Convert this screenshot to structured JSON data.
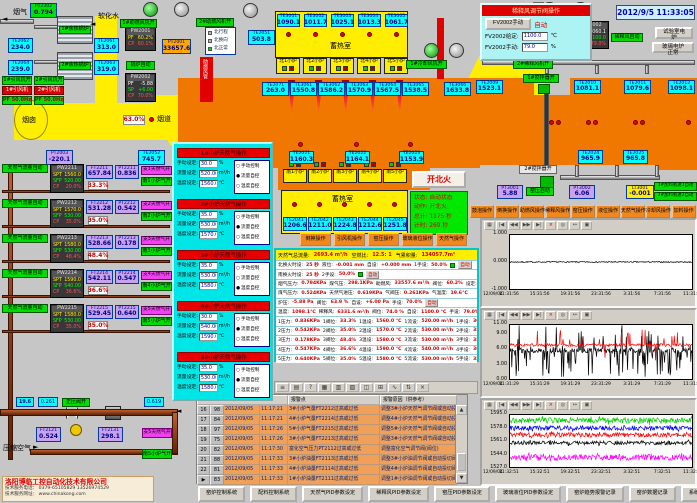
{
  "clock": "2012/9/5 11:33:05",
  "labels": {
    "flue_gas": "烟气",
    "soft_water": "软化水",
    "chimney": "烟囱",
    "flue": "烟道",
    "regen_north": "蓄热室",
    "regen_south": "蓄热室",
    "duct_red": "助燃风管",
    "compressed_air": "压缩空气",
    "fan_open": "开"
  },
  "top_left": {
    "pt2302": {
      "id": "PT2302",
      "value": "0.794"
    },
    "boilers": [
      "1#余热锅炉",
      "2#余热锅炉"
    ],
    "te": [
      {
        "id": "TE2062",
        "value": "234.0"
      },
      {
        "id": "TE2061",
        "value": "313.0"
      },
      {
        "id": "TE2064",
        "value": "239.0"
      },
      {
        "id": "TE2063",
        "value": "319.0"
      }
    ],
    "fan_status": [
      "1#引风机开",
      "2#引风机开"
    ],
    "fan_names": [
      "1#引风机",
      "2#引风机"
    ],
    "fan_freq": [
      "PF 50.0Hz",
      "PF 50.0Hz"
    ],
    "flue_valve_pct": "63.0%",
    "pt2003": {
      "id": "PT2003",
      "value": "-220.1"
    },
    "te2052": {
      "id": "TE2052",
      "value": "745.7"
    }
  },
  "top_center": {
    "te2051": {
      "id": "TE2051",
      "value": "503.8"
    },
    "regen_te": [
      {
        "id": "TE3001",
        "value": "1090.1"
      },
      {
        "id": "TE3002",
        "value": "1011.7"
      },
      {
        "id": "TE3003",
        "value": "1025.1"
      },
      {
        "id": "TE3004",
        "value": "1013.3"
      },
      {
        "id": "TE3005",
        "value": "1061.7"
      }
    ],
    "north_furnaces": [
      "北1小炉",
      "北2小炉",
      "北3小炉",
      "北4小炉",
      "北5小炉"
    ],
    "pw2001": {
      "id": "PW2001",
      "rows": [
        {
          "k": "PF",
          "v": "60.2%",
          "c": "cy"
        },
        {
          "k": "CP",
          "v": "60.1%",
          "c": "cr"
        }
      ]
    },
    "pt2001": {
      "id": "PT2001",
      "value": "33657.6"
    },
    "boiler_auto": "锅炉自动",
    "pw2002": {
      "id": "PW2002",
      "rows": [
        {
          "k": "PF",
          "v": "-5.88",
          "c": "cw"
        },
        {
          "k": "SP",
          "v": "+6.00",
          "c": "cg"
        },
        {
          "k": "CP",
          "v": "70.0%",
          "c": "cr"
        }
      ]
    },
    "fan1_status": "1#助燃风机开",
    "fan2_status": "2#助燃风机开",
    "mode_list": [
      {
        "t": "北行程",
        "on": false
      },
      {
        "t": "北换向",
        "on": false
      },
      {
        "t": "北正常",
        "on": true
      }
    ],
    "cooling_fan": "1#冷却风机开"
  },
  "furnace": {
    "top_te": [
      {
        "id": "TE2071",
        "value": "263.0"
      },
      {
        "id": "TE3061",
        "value": "1550.8"
      },
      {
        "id": "TE3062",
        "value": "1586.2"
      },
      {
        "id": "TE3063",
        "value": "1570.9"
      },
      {
        "id": "TE3064",
        "value": "1567.5"
      },
      {
        "id": "TE3065",
        "value": "1538.5"
      },
      {
        "id": "TE3066",
        "value": "1633.8"
      }
    ],
    "right_te": [
      {
        "id": "TE2009",
        "value": "1523.1"
      },
      {
        "id": "TE2010",
        "value": "1081.1"
      },
      {
        "id": "TE2011",
        "value": "1079.6"
      },
      {
        "id": "TE2012",
        "value": "1098.1"
      }
    ],
    "mid_te": [
      {
        "id": "TE2021",
        "value": "1160.3"
      },
      {
        "id": "TE2022",
        "value": "1164.1"
      },
      {
        "id": "TE2023",
        "value": "1153.9"
      }
    ],
    "south_furnaces": [
      "南1小炉",
      "南2小炉",
      "南3小炉",
      "南4小炉",
      "南5小炉"
    ],
    "south_te": [
      {
        "id": "TE2041",
        "value": "1206.6"
      },
      {
        "id": "TE2042",
        "value": "1211.0"
      },
      {
        "id": "TE2043",
        "value": "1224.8"
      },
      {
        "id": "TE2044",
        "value": "1212.6"
      },
      {
        "id": "TE2045",
        "value": "1251.8"
      }
    ],
    "bottom_te": [
      {
        "id": "TE2024",
        "value": "965.9"
      },
      {
        "id": "TE2025",
        "value": "965.8"
      }
    ],
    "ignite_button": "开北火",
    "status": [
      {
        "k": "状态:",
        "v": "自动状态"
      },
      {
        "k": "动作:",
        "v": "开北火"
      },
      {
        "k": "总计:",
        "v": "1175 秒"
      },
      {
        "k": "计时:",
        "v": "269 秒"
      }
    ],
    "stirrer1": "1#搅拌器开",
    "stirrer2": "2#搅拌器开",
    "pt3001": {
      "id": "PT3001",
      "value": "5.88"
    },
    "kiln_auto": "窑压自动",
    "pt3002": {
      "id": "PT3002",
      "value": "6.06"
    },
    "lt3001": {
      "id": "LT3001",
      "value": "-0.001"
    },
    "feeders": [
      "1#加料机进1自动",
      "2#加料机进2自动"
    ]
  },
  "dilution_popup": {
    "title": "稀释风调节阀操作",
    "manual_btn": "FV2002手动",
    "auto_label": "自动",
    "rows": [
      {
        "k": "FV2002给定:",
        "v": "1100.0",
        "u": "℃"
      },
      {
        "k": "FV2002手动:",
        "v": "79.0",
        "u": "%"
      }
    ]
  },
  "dilution": {
    "fv2002": {
      "id": "FV2002",
      "rows": [
        {
          "k": "PV",
          "v": "1060.1",
          "c": "cw"
        },
        {
          "k": "SP",
          "v": "1100.0",
          "c": "cg"
        },
        {
          "k": "CP",
          "v": "79.0%",
          "c": "cr"
        }
      ]
    },
    "auto_label": "稀释风自动",
    "pct": "74.0%",
    "ft2002": {
      "id": "FT2002",
      "value": "6331.6"
    },
    "fan2": "2#稀释风机开",
    "test_buttons": [
      "试验室电炉",
      "玻璃电炉正常"
    ]
  },
  "right_buttons": [
    "鼓泡操作",
    "倒换操作",
    "助燃风操作",
    "稀释风操作",
    "窑压操作",
    "液位操作",
    "天然气操作",
    "冷却风操作",
    "加料操作"
  ],
  "center_buttons": [
    "倒换操作",
    "引风机操作",
    "窑压操作",
    "玻璃液位操作",
    "天然气操作"
  ],
  "gas_popup": {
    "field_labels": [
      "手动设定:",
      "流量设定:",
      "温度设定:"
    ],
    "units": [
      "%",
      "m³/h",
      "℃"
    ],
    "modes": [
      "手动控制",
      "流量自控",
      "温度自控"
    ],
    "sections": [
      {
        "title": "1#小炉天然气操作",
        "manual": "30.0",
        "flow": "520.00",
        "temp": "1560.0",
        "mode": 1
      },
      {
        "title": "2#小炉天然气操作",
        "manual": "35.0",
        "flow": "530.00",
        "temp": "1570.0",
        "mode": 1
      },
      {
        "title": "3#小炉天然气操作",
        "manual": "35.0",
        "flow": "530.00",
        "temp": "1580.0",
        "mode": 2
      },
      {
        "title": "4#小炉天然气操作",
        "manual": "30.0",
        "flow": "540.00",
        "temp": "1590.0",
        "mode": 1
      },
      {
        "title": "5#小炉天然气操作",
        "manual": "35.0",
        "flow": "530.00",
        "temp": "1580.0",
        "mode": 1
      }
    ]
  },
  "gas_rows": [
    {
      "auto": "天然气流量自动",
      "pw": "PW2211",
      "spt": "1560.0",
      "sfp": "520.00",
      "cp": "20.0%",
      "ft_id": "FT2211",
      "ft": "657.84",
      "pt_id": "PT2211",
      "pt": "0.836",
      "pct": "33.3%",
      "open1": "支1天然气开",
      "open2": "南1小炉气开"
    },
    {
      "auto": "天然气流量自动",
      "pw": "PW2212",
      "spt": "1570.0",
      "sfp": "530.00",
      "cp": "35.0%",
      "ft_id": "FT2212",
      "ft": "531.28",
      "pt_id": "PT2212",
      "pt": "0.542",
      "pct": "35.0%",
      "open1": "支2天然气开",
      "open2": "南2小炉气开"
    },
    {
      "auto": "天然气流量自动",
      "pw": "PW2213",
      "spt": "1580.0",
      "sfp": "530.00",
      "cp": "48.4%",
      "ft_id": "FT2213",
      "ft": "528.66",
      "pt_id": "PT2213",
      "pt": "0.178",
      "pct": "48.4%",
      "open1": "支3天然气开",
      "open2": "南3小炉气开"
    },
    {
      "auto": "天然气流量自动",
      "pw": "PW2214",
      "spt": "1590.0",
      "sfp": "540.00",
      "cp": "36.6%",
      "ft_id": "FT2214",
      "ft": "542.11",
      "pt_id": "PT2214",
      "pt": "0.547",
      "pct": "36.6%",
      "open1": "支4天然气开",
      "open2": "南4小炉气开"
    },
    {
      "auto": "天然气流量自动",
      "pw": "PW2215",
      "spt": "1580.0",
      "sfp": "530.00",
      "cp": "35.0%",
      "ft_id": "FT2215",
      "ft": "529.45",
      "pt_id": "PT2215",
      "pt": "0.640",
      "pct": "35.0%",
      "open1": "支5天然气开",
      "open2": "南5小炉气开"
    }
  ],
  "data_panel": {
    "header": [
      {
        "k": "天然气总流量:",
        "v": "2693.4 m³/h"
      },
      {
        "k": "空燃比:",
        "v": "12.5: 1"
      },
      {
        "k": "气累积量:",
        "v": "134057.7m³"
      }
    ],
    "rows": [
      {
        "pairs": [
          [
            "北换火时设:",
            "25 秒"
          ],
          [
            "液位:",
            "-0.001 mm"
          ],
          [
            "自设:",
            "+0.000 mm"
          ],
          [
            "1手设:",
            "50.0%"
          ]
        ],
        "tag": "自动",
        "tagc": "r",
        "gsq": true
      },
      {
        "pairs": [
          [
            "南换火时设:",
            "25 秒"
          ],
          [
            "2手设:",
            "50.0%"
          ]
        ],
        "tag": "自动",
        "tagc": "r",
        "gsq": true
      },
      {
        "pairs": [
          [
            "烟气压力:",
            "0.794KPa"
          ],
          [
            "煤气压:",
            "298.1KPa"
          ],
          [
            "助燃风:",
            "33557.6 m³/h"
          ],
          [
            "阀位:",
            "60.2%"
          ],
          [
            "设定:",
            "60.0%"
          ]
        ]
      },
      {
        "pairs": [
          [
            "煤气压力:",
            "0.524KPa"
          ],
          [
            "天然气进压:",
            "0.619KPa"
          ],
          [
            "气阀压:",
            "0.261KPa"
          ],
          [
            "气温度:",
            "19.6℃"
          ]
        ]
      },
      {
        "pairs": [
          [
            "炉压:",
            "-5.88 Pa"
          ],
          [
            "阀位:",
            "63.9 %"
          ],
          [
            "自设:",
            "+6.00 Pa"
          ],
          [
            "手设:",
            "70.0%"
          ]
        ],
        "tag": "自动",
        "tagc": "r"
      },
      {
        "pairs": [
          [
            "温度:",
            "1098.1℃"
          ],
          [
            "稀释风:",
            "6331.6 m³/h"
          ],
          [
            "阀位:",
            "74.0 %"
          ],
          [
            "自设:",
            "1100.0 ℃"
          ],
          [
            "手设:",
            "79.0%"
          ]
        ],
        "tag": "自动",
        "tagc": "r"
      },
      {
        "pairs": [
          [
            "1压力:",
            "0.836KPa"
          ],
          [
            "1阀位:",
            "33.3%"
          ],
          [
            "1温设:",
            "1560.0 ℃"
          ],
          [
            "1流设:",
            "520.00 m³/h"
          ],
          [
            "1手设:",
            "30.0%"
          ]
        ],
        "tag": "流控",
        "tagc": "b"
      },
      {
        "pairs": [
          [
            "2压力:",
            "0.542KPa"
          ],
          [
            "2阀位:",
            "35.0%"
          ],
          [
            "2温设:",
            "1570.0 ℃"
          ],
          [
            "2流设:",
            "530.00 m³/h"
          ],
          [
            "2手设:",
            "35.0%"
          ]
        ],
        "tag": "流控",
        "tagc": "b"
      },
      {
        "pairs": [
          [
            "3压力:",
            "0.178KPa"
          ],
          [
            "3阀位:",
            "48.4%"
          ],
          [
            "3温设:",
            "1580.0 ℃"
          ],
          [
            "3流设:",
            "530.00 m³/h"
          ],
          [
            "3手设:",
            "35.0%"
          ]
        ],
        "tag": "温控",
        "tagc": "b"
      },
      {
        "pairs": [
          [
            "4压力:",
            "0.547KPa"
          ],
          [
            "4阀位:",
            "36.6%"
          ],
          [
            "4温设:",
            "1590.0 ℃"
          ],
          [
            "4流设:",
            "540.00 m³/h"
          ],
          [
            "4手设:",
            "30.0%"
          ]
        ],
        "tag": "流控",
        "tagc": "b"
      },
      {
        "pairs": [
          [
            "5压力:",
            "0.640KPa"
          ],
          [
            "5阀位:",
            "35.0%"
          ],
          [
            "5温设:",
            "1580.0 ℃"
          ],
          [
            "5流设:",
            "530.00 m³/h"
          ],
          [
            "5手设:",
            "35.0%"
          ]
        ],
        "tag": "流控",
        "tagc": "b"
      }
    ]
  },
  "toolbar_icons": [
    "≡",
    "▤",
    "?",
    "▦",
    "▥",
    "▧",
    "◫",
    "⊞",
    "∿",
    "⇅",
    "×"
  ],
  "alarm_table": {
    "col_headers": [
      "报警点",
      "报警原因（供参考）"
    ],
    "rows": [
      {
        "no": "16",
        "code": "98",
        "date": "2012/09/05",
        "time": "11:17:21",
        "point": "3#小炉气量FT2212过高或过低",
        "reason": "调整3#小炉天然气调节阀或自动投切阀"
      },
      {
        "no": "17",
        "code": "84",
        "date": "2012/09/05",
        "time": "11:17:21",
        "point": "4#小炉气量FT2214过高或过低",
        "reason": "调整4#小炉天然气调节阀或自动投切阀"
      },
      {
        "no": "18",
        "code": "97",
        "date": "2012/09/05",
        "time": "11:17:26",
        "point": "5#小炉气量FT2215过高或过低",
        "reason": "调整5#小炉天然气调节阀或自动投切阀"
      },
      {
        "no": "19",
        "code": "75",
        "date": "2012/09/05",
        "time": "11:17:26",
        "point": "3#小炉气量FT2213过高或过低",
        "reason": "调整3#小炉天然气调节阀或自动投切阀"
      },
      {
        "no": "20",
        "code": "82",
        "date": "2012/09/05",
        "time": "11:17:30",
        "point": "富化空气压力PT2112过高或过低",
        "reason": "调整富化空气调节阀(阀位)"
      },
      {
        "no": "21",
        "code": "88",
        "date": "2012/09/05",
        "time": "11:17:33",
        "point": "3#小炉油量FT2113过高或过低",
        "reason": "调整3#小炉油调节阀或自动投切阀"
      },
      {
        "no": "22",
        "code": "81",
        "date": "2012/09/05",
        "time": "11:17:33",
        "point": "4#小炉油量FT2114过高或过低",
        "reason": "调整4#小炉油调节阀或自动投切阀"
      },
      {
        "no": "23",
        "code": "83",
        "date": "2012/09/05",
        "time": "11:17:33",
        "point": "1#小炉油量FT2111过高或过低",
        "reason": "调整1#小炉油调节阀或自动投切阀",
        "selected": true
      }
    ]
  },
  "pipes_bottom": {
    "temp": "19.6",
    "vpress": "0.261",
    "valve_open": "正压阀开",
    "inpress": "0.619",
    "ft2121": {
      "id": "FT2121",
      "value": "0.524"
    },
    "ft2131": {
      "id": "FT2131",
      "value": "298.1"
    },
    "open1": "支5天然气开",
    "open2": "南5小炉气开"
  },
  "company": {
    "name": "洛阳博临工控自动化技术有限公司",
    "phone": "技术服务电话： 0379-65105829  13526974529",
    "web": "技术服务网址： www.chinakong.com"
  },
  "bottom_buttons": [
    "窑炉控制系统",
    "配料控制系统",
    "天然气PID参数设定",
    "稀释风PID参数设定",
    "窑压PID参数设定",
    "玻璃液位PID参数设定",
    "窑炉趋势报警记录",
    "窑炉数据记录",
    "系统报警点设定"
  ],
  "chart_toolbar": [
    "▦",
    "|◀",
    "◀◀",
    "▶▶",
    "▶|",
    "×",
    "◎",
    "↔",
    "▣"
  ],
  "charts": [
    {
      "id": "kiln-pressure-trend",
      "yticks": [
        "1.000",
        "0.000",
        "-1.000"
      ],
      "ymin": -1,
      "ymax": 1,
      "xlabels": [
        "12/09/04",
        "11:31:56",
        "15:31:56",
        "19:31:56",
        "23:31:56",
        "3:31:56",
        "7:31:56",
        "11:31:56"
      ],
      "series": [
        {
          "name": "窑压",
          "color": "#000000",
          "mean": 0,
          "amp": 0.02,
          "spike": 0,
          "spikep": 0,
          "updownp": 0.5
        }
      ]
    },
    {
      "id": "pressure-noisy-trend",
      "yticks": [
        "11.00",
        "9.00",
        "6.00",
        "3.00",
        "0.00"
      ],
      "ymin": 0,
      "ymax": 11,
      "xlabels": [
        "12/09/04",
        "11:31:29",
        "15:31:29",
        "19:31:29",
        "23:31:29",
        "3:31:29",
        "7:31:29",
        "11:31:29"
      ],
      "series": [
        {
          "name": "压力1",
          "color": "#000000",
          "mean": 5.8,
          "amp": 0.5,
          "spike": 5.4,
          "spikep": 0.3,
          "updownp": 0.3
        },
        {
          "name": "压力2",
          "color": "#ff0000",
          "mean": 6.9,
          "amp": 0.3,
          "spike": 3.2,
          "spikep": 0.1,
          "updownp": 0.85
        }
      ]
    },
    {
      "id": "furnace-temp-trend",
      "yticks": [
        "1595.0",
        "1578.0",
        "1561.0",
        "1544.0",
        "1527.0"
      ],
      "ymin": 1527,
      "ymax": 1595,
      "xlabels": [
        "12/09/04",
        "11:32:51",
        "15:32:51",
        "19:32:51",
        "23:32:51",
        "3:32:51",
        "7:32:51",
        "11:32:51"
      ],
      "series": [
        {
          "name": "1#温度",
          "color": "#00cc00",
          "mean": 1588,
          "amp": 3.5,
          "spike": 6,
          "spikep": 0.08,
          "updownp": 0.5
        },
        {
          "name": "2#温度",
          "color": "#0000ff",
          "mean": 1578,
          "amp": 3,
          "spike": 5,
          "spikep": 0.08,
          "updownp": 0.5
        },
        {
          "name": "3#温度",
          "color": "#ff0000",
          "mean": 1569,
          "amp": 3,
          "spike": 5,
          "spikep": 0.06,
          "updownp": 0.5
        },
        {
          "name": "4#温度",
          "color": "#000000",
          "mean": 1558.5,
          "amp": 2.5,
          "spike": 4,
          "spikep": 0.06,
          "updownp": 0.5
        },
        {
          "name": "5#温度",
          "color": "#ff00ff",
          "mean": 1539.5,
          "amp": 4,
          "spike": 6,
          "spikep": 0.1,
          "updownp": 0.5
        }
      ]
    }
  ]
}
